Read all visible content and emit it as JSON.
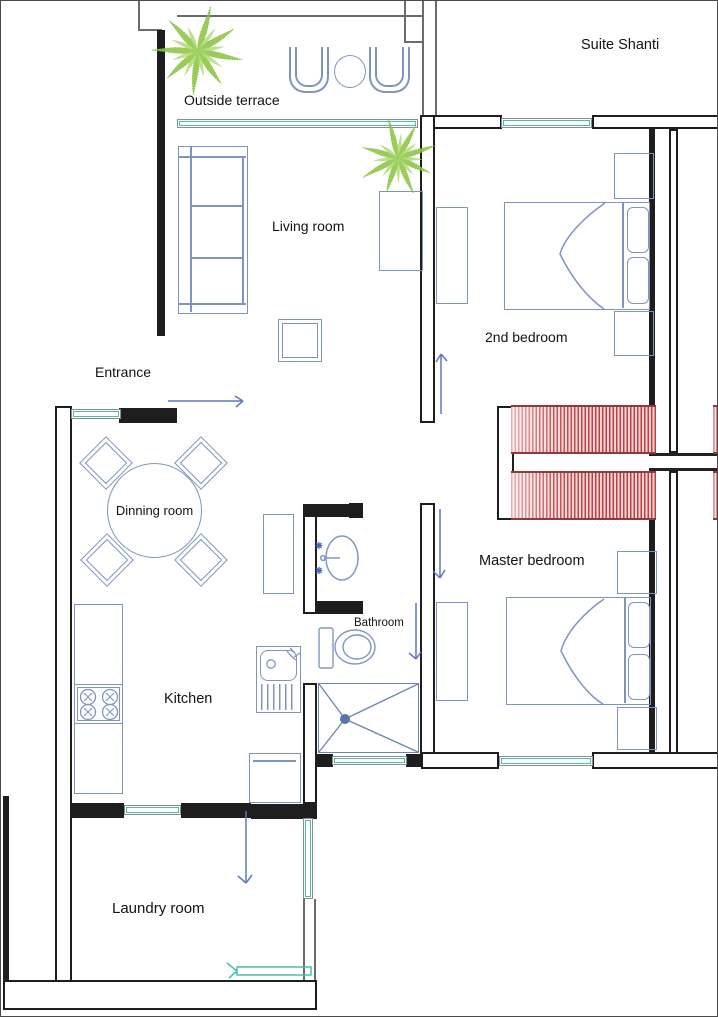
{
  "title": "Suite Shanti",
  "rooms": {
    "outside_terrace": {
      "label": "Outside terrace"
    },
    "living_room": {
      "label": "Living room"
    },
    "second_bedroom": {
      "label": "2nd bedroom"
    },
    "entrance": {
      "label": "Entrance"
    },
    "dinning_room": {
      "label": "Dinning room"
    },
    "kitchen": {
      "label": "Kitchen"
    },
    "bathroom": {
      "label": "Bathroom"
    },
    "master_bedroom": {
      "label": "Master bedroom"
    },
    "laundry_room": {
      "label": "Laundry room"
    }
  },
  "colors": {
    "wall": "#1e1e1e",
    "furniture_stroke": "#8094c3",
    "window_teal": "#49bfae",
    "closet_stripe_red": "#c23d3f",
    "plant_green": "#8dc63f",
    "door_swing_blue": "#5d79c4"
  }
}
